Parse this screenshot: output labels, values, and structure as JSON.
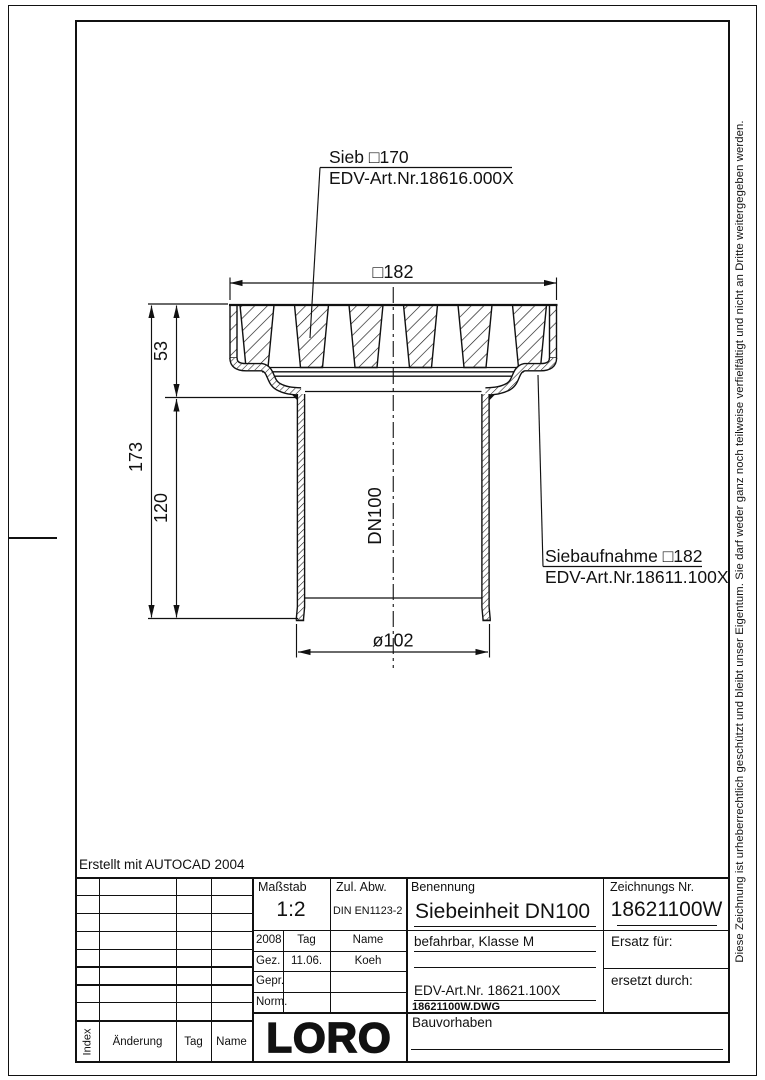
{
  "note_autocad": "Erstellt mit AUTOCAD 2004",
  "copyright_vertical": "Diese Zeichnung ist urheberrechtlich geschützt und bleibt unser Eigentum. Sie darf weder ganz noch teilweise verfielfältigt und nicht an Dritte weitergegeben werden.",
  "drawing": {
    "callouts": {
      "sieb_title": "Sieb □170",
      "sieb_edv": "EDV-Art.Nr.18616.000X",
      "aufnahme_title": "Siebaufnahme □182",
      "aufnahme_edv": "EDV-Art.Nr.18611.100X"
    },
    "dimensions": {
      "top_width": "□182",
      "height_total": "173",
      "height_sieve": "53",
      "height_pipe": "120",
      "pipe_label": "DN100",
      "pipe_diameter": "ø102"
    }
  },
  "titleblock": {
    "massstab_label": "Maßstab",
    "massstab_value": "1:2",
    "zul_abw_label": "Zul. Abw.",
    "zul_abw_value": "DIN EN1123-2",
    "benennung_label": "Benennung",
    "benennung_value": "Siebeinheit DN100",
    "zeichnungs_label": "Zeichnungs Nr.",
    "zeichnungs_value": "18621100W",
    "year": "2008",
    "col_tag": "Tag",
    "col_name": "Name",
    "gez_label": "Gez.",
    "gez_tag": "11.06.",
    "gez_name": "Koeh",
    "gepr_label": "Gepr.",
    "norm_label": "Norm.",
    "class_note": "befahrbar, Klasse M",
    "edv_value": "EDV-Art.Nr. 18621.100X",
    "dwg_value": "18621100W.DWG",
    "ersatz_label": "Ersatz für:",
    "ersetzt_label": "ersetzt durch:",
    "bauvorhaben_label": "Bauvorhaben",
    "logo": "LORO",
    "index_label": "Index",
    "aenderung_label": "Änderung",
    "tag_label": "Tag",
    "name_label": "Name"
  }
}
